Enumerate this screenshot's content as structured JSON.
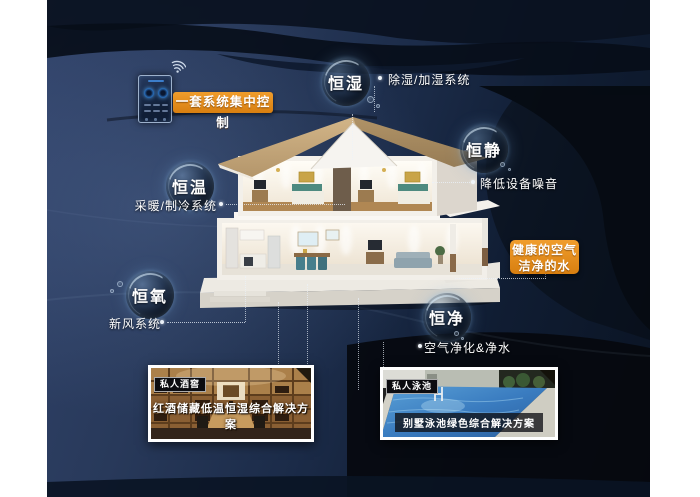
{
  "colors": {
    "accent_orange": "#e0881c",
    "canvas_navy": "#28395a",
    "wave_black": "#070c15",
    "bubble_glow": "#9fc3e0",
    "annotation_text": "#ffffff"
  },
  "control_panel": {
    "label": "一套系统集中控制"
  },
  "bubbles": {
    "humidity": {
      "label": "恒湿",
      "annotation": "除湿/加湿系统"
    },
    "quiet": {
      "label": "恒静",
      "annotation": "降低设备噪音"
    },
    "temperature": {
      "label": "恒温",
      "annotation": "采暖/制冷系统"
    },
    "oxygen": {
      "label": "恒氧",
      "annotation": "新风系统"
    },
    "purity": {
      "label": "恒净",
      "annotation": "空气净化&净水"
    }
  },
  "highlight_box": {
    "line1": "健康的空气",
    "line2": "洁净的水"
  },
  "photos": {
    "wine_cellar": {
      "tag": "私人酒窖",
      "caption": "红酒储藏低温恒湿综合解决方案"
    },
    "pool": {
      "tag": "私人泳池",
      "caption": "别墅泳池绿色综合解决方案"
    }
  }
}
